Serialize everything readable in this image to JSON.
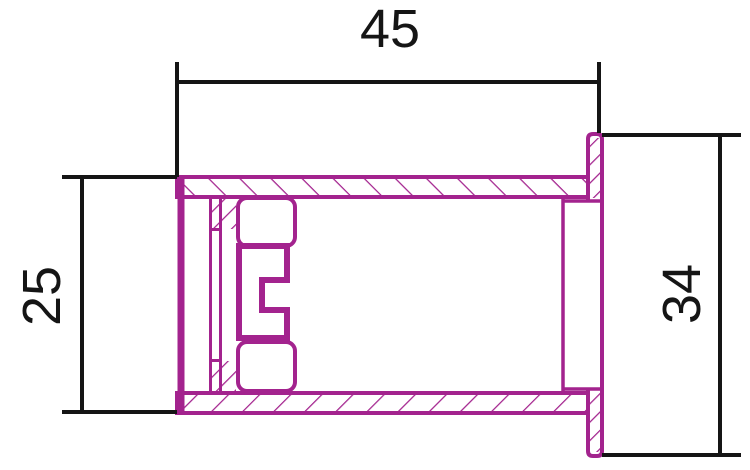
{
  "drawing": {
    "background_color": "#ffffff",
    "part_color": "#a3238e",
    "dimension_ink_color": "#151515"
  },
  "dimensions": {
    "overall_length": {
      "label": "45",
      "orientation": "horizontal"
    },
    "body_height": {
      "label": "25",
      "orientation": "vertical-rotated"
    },
    "flange_height": {
      "label": "34",
      "orientation": "vertical-rotated"
    }
  }
}
